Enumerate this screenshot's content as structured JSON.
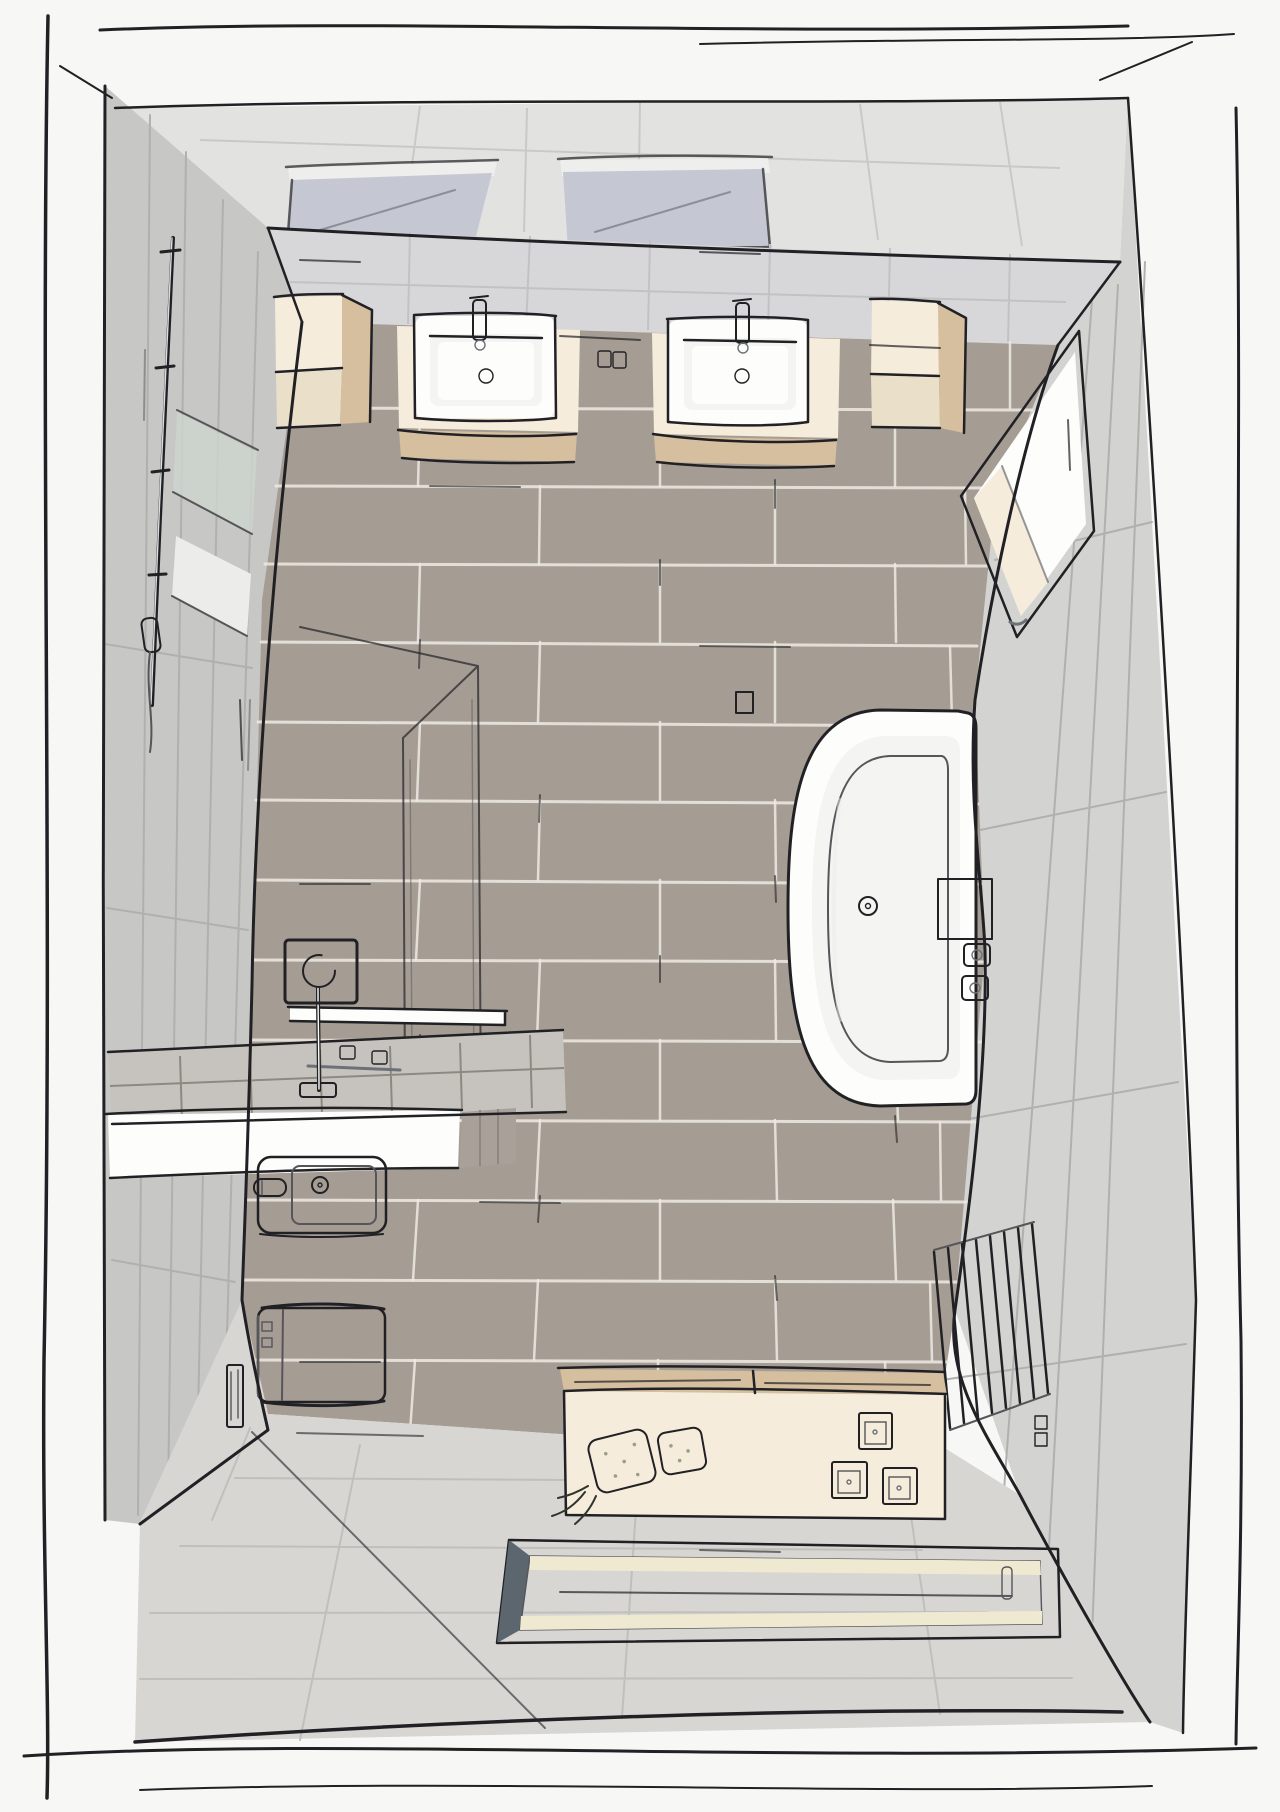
{
  "meta": {
    "title": "Bathroom design sketch - bird's-eye view",
    "style": "hand-drawn 3D architectural rendering, no text labels",
    "view": "top-down wide-angle perspective of a complete bathroom",
    "canvas": {
      "width": 1280,
      "height": 1812
    }
  },
  "palette": {
    "page": "#f7f7f5",
    "line": "#212125",
    "softLine": "#55555a",
    "ceiling": "#e2e2e0",
    "ceilJoint": "#c9c9c7",
    "wallBack": "#d7d7d9",
    "backJoint": "#c2c2c4",
    "wallLeft": "#c7c7c5",
    "wallRight": "#d3d3d1",
    "wallJoint": "#b0b0ae",
    "skylight": "#c5c8d2",
    "skylightBar": "#eeeeec",
    "floorTile": "#a59d94",
    "grout": "#edeae4",
    "floorLight": "#d7d6d3",
    "groutLight": "#bfbfbc",
    "white": "#fdfdfc",
    "whiteShade": "#ececea",
    "basin": "#f4f4f2",
    "cream": "#f5ecdb",
    "creamShade": "#eadfc9",
    "wood": "#d5bf9f",
    "woodDark": "#b99a72",
    "slate": "#76818a",
    "slateDark": "#5c666e",
    "glass": "#ccd3cd",
    "benchTile": "#c6c3be",
    "benchSide": "#a9a199",
    "benchJoint": "#8f8880",
    "plant": "#41463f",
    "plantDot": "#98a089",
    "chrome": "#d9dcde",
    "chromeDark": "#6b7176",
    "flushPlate": "#9a7a55",
    "matStripe": "#efe9d2"
  },
  "objects": {
    "scene": "Bathroom bird's-eye sketch",
    "sketchBorder": "Hand-drawn page border",
    "ceiling": "Ceiling strip",
    "skylightLeft": "Left ceiling skylight",
    "skylightRight": "Right ceiling skylight",
    "backWall": "Back wall with tiles",
    "leftWall": "Left wall with tall tile panels",
    "rightWall": "Right wall with tiles",
    "floor": "Main floor with large taupe tiles",
    "entranceFloor": "Entrance floor with light grey tiles",
    "cabinetLeft": "Left cube wall cabinet",
    "cabinetRight": "Right cube wall cabinet",
    "vanityLeft": "Left washbasin vanity with drawers",
    "vanityRight": "Right washbasin vanity with drawers",
    "sinkLeft": "Left rectangular washbasin",
    "sinkRight": "Right rectangular washbasin",
    "faucetLeft": "Left basin mixer tap",
    "faucetRight": "Right basin mixer tap",
    "lightSwitch": "Double light switch between basins",
    "wallMirror": "Framed mirror on right wall",
    "showerRail": "Shower rail with hand shower on left wall",
    "wallShelfGlass": "Glass shelf panel on left wall",
    "showerScreen": "Walk-in shower glass screen",
    "showerHead": "Square rain shower head",
    "showerShelf": "Shower storage shelf",
    "showerBench": "Tiled shower bench",
    "benchControls": "Shower controls on bench",
    "bidet": "Bidet",
    "paperHolder": "Paper / towel roll holder",
    "toilet": "Wall-hung toilet",
    "flushPlate": "Flush plate on wall",
    "bathtub": "Oval built-in bathtub",
    "tubDeck": "Bathtub deck shelf",
    "tubControls": "Bathtub faucet handles",
    "tubDrain": "Bathtub drain",
    "towelRadiator": "Ladder towel radiator",
    "wallSocket": "Wall socket pair",
    "storageBench": "Storage sideboard with towels",
    "plantLarge": "Large towel basket / plant",
    "plantSmall": "Small towel basket / plant",
    "boxA": "Storage box 1",
    "boxB": "Storage box 2",
    "boxC": "Storage box 3",
    "bathMat": "Framed bath mat on floor"
  }
}
